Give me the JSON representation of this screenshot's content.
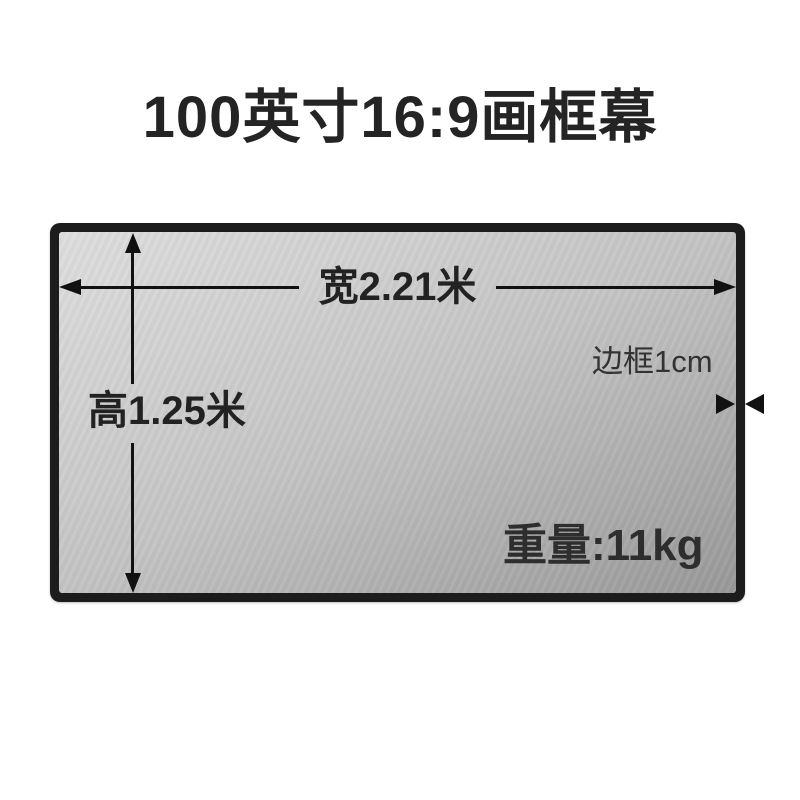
{
  "title": "100英寸16:9画框幕",
  "screen_diagram": {
    "width_label": "宽2.21米",
    "height_label": "高1.25米",
    "frame_label": "边框1cm",
    "weight_label": "重量:11kg",
    "colors": {
      "frame": "#1c1c1c",
      "screen_light": "#e1e1e1",
      "screen_mid": "#c6c6c6",
      "screen_dark": "#979797",
      "text_dark": "#222222",
      "arrow": "#111111",
      "page_background": "#ffffff"
    }
  }
}
